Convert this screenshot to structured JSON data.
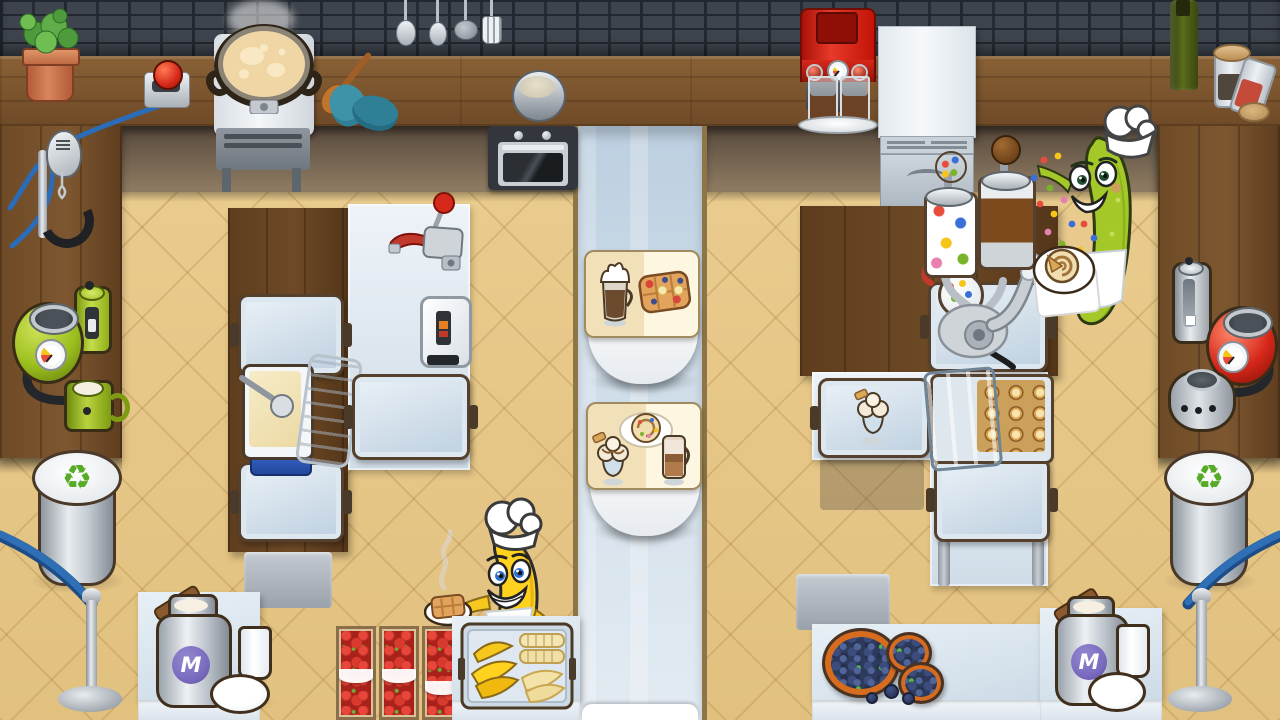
{
  "scene": {
    "name": "fruit-chefs-kitchen",
    "milk_can_label": "M"
  },
  "palette": {
    "brick_wall": "#3e444d",
    "wood_counter": "#7a5430",
    "wood_dark": "#63411f",
    "floor_tan": "#e9cb8f",
    "corridor_blue": "#c3d4e3",
    "order_card_bg": "#fdf3d9",
    "tray_blue": "#c9d9e8",
    "banana_yellow": "#ffd21f",
    "cucumber_green": "#9fca1e",
    "machine_red": "#d6281a",
    "machine_green": "#a1c32c",
    "recycle_green": "#58ab27",
    "rope_blue": "#2e6fb5",
    "milk_badge_purple": "#7a6bbf",
    "strawberry_red": "#c23227",
    "blueberry_blue": "#2e3a5c"
  },
  "orders": [
    {
      "id": 1,
      "items": [
        {
          "icon": "whipped-cream-coffee-icon"
        },
        {
          "icon": "fruit-topped-waffle-icon"
        }
      ]
    },
    {
      "id": 2,
      "items": [
        {
          "icon": "sprinkle-cinnamon-roll-icon"
        },
        {
          "icon": "ice-cream-sundae-icon"
        },
        {
          "icon": "glass-latte-icon"
        }
      ]
    }
  ],
  "characters": [
    {
      "id": "banana-chef",
      "holding": "waffle-plate-icon"
    },
    {
      "id": "cucumber-chef",
      "holding": "cinnamon-roll-plate-icon"
    }
  ],
  "recycle_symbol": "♻"
}
